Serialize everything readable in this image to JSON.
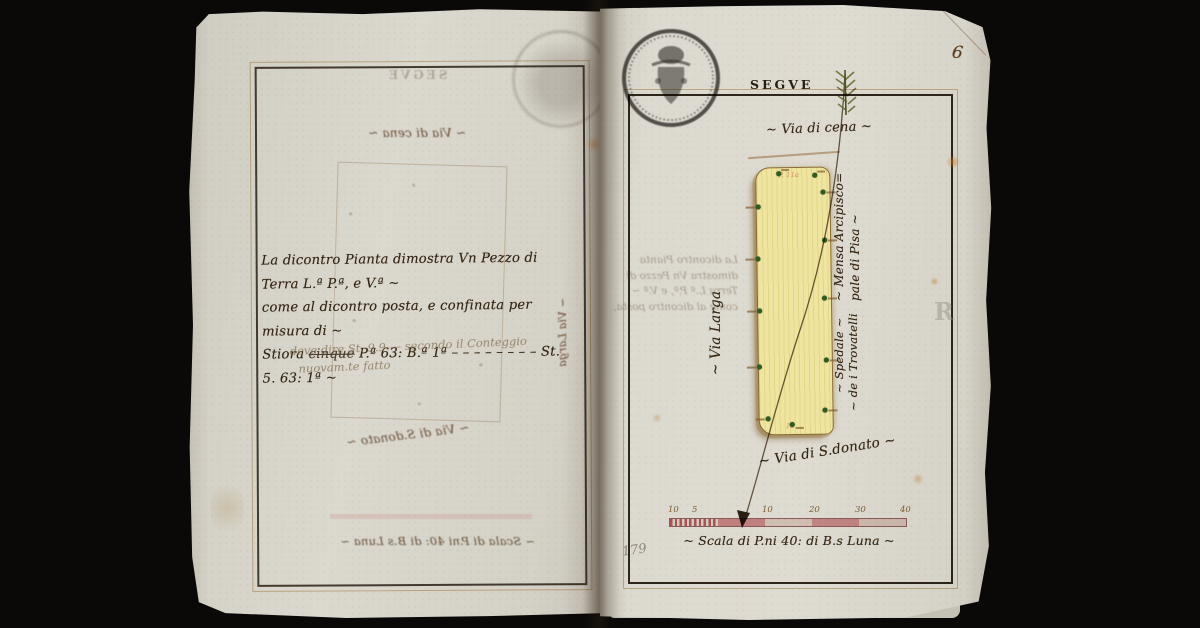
{
  "left_page": {
    "ink_text": {
      "line1": "La dicontro Pianta dimostra Vn Pezzo di Terra L.ª P.ª, e V.ª ~",
      "line2": "come al dicontro posta, e confinata per misura di ~",
      "line3_pre": "Stiora ",
      "line3_struck": "cinque",
      "line3_post": " P.ª 63: B.ª 1ª  – – – – – – – –  St. 5. 63: 1ª ~"
    },
    "pencil_note": {
      "line1": "deve dire St. 9.9 — secondo il Conteggio",
      "line2": "nuovam.te fatto"
    }
  },
  "right_page": {
    "page_number": "6",
    "header": "SEGVE",
    "folio_number": "179",
    "watermark_letter": "R",
    "labels": {
      "via_cena": "~ Via di cena ~",
      "via_larga": "~ Via Larga",
      "mensa_line1": "~ Mensa Arcipisco=",
      "mensa_line2": "pale di Pisa ~",
      "spedale_line1": "~ Spedale ~",
      "spedale_line2": "~ de i Trovatelli",
      "via_donato": "~ Via di S.donato ~",
      "parcel_mark_top": "P. 11a",
      "parcel_mark_bottom": "1a"
    },
    "scale": {
      "caption": "~ Scala di P.ni 40: di B.s Luna ~",
      "ticks": [
        "10",
        "5",
        "10",
        "20",
        "30",
        "40"
      ]
    }
  },
  "colors": {
    "ink": "#3f2e1a",
    "pencil": "#8d8678",
    "scale_red": "#c9636d",
    "parcel_fill": "#efe5a0",
    "parcel_outline": "#8a6a34",
    "marker_green": "#2f5c20",
    "stamp_black": "#1c1713",
    "paper": "#d8d5cb"
  }
}
